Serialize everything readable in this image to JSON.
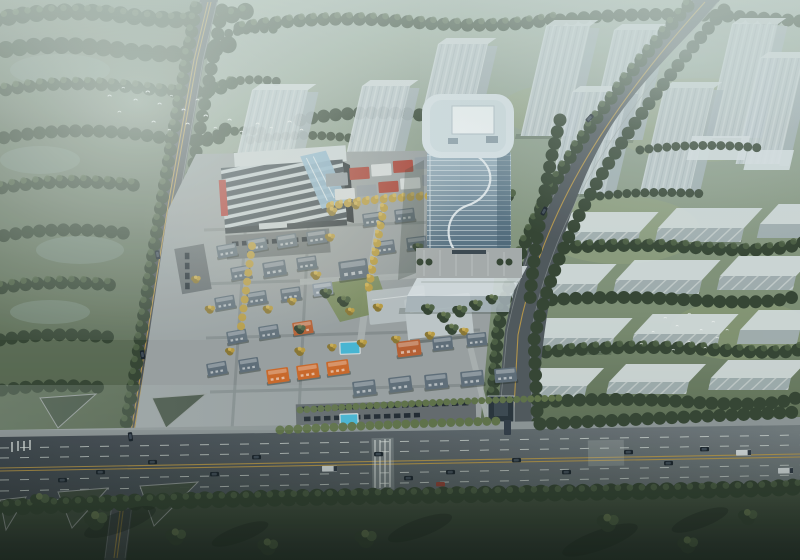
{
  "scene": {
    "description": "Aerial dusk rendering of a mixed-use development: curved glass office tower, striped-roof commercial anchor with red signage, low-rise European-style retail and villa village with slate and terracotta roofs and turquoise pools, translucent context towers and slabs, forest in haze, bird flocks, and a multi-lane boulevard crossed by two side roads."
  },
  "palette": {
    "tree_dark": "#31402f",
    "tree_mid": "#4c5f42",
    "tree_light": "#687950",
    "tree_yellow": "#b99a3f",
    "tree_yellow2": "#d3b254",
    "grass_cool": "#7e9186",
    "ghost_face": "#c5cfd6",
    "ghost_side": "#a7b3ba",
    "ghost_top": "#dde4e8",
    "glass_top": "#a7bcc9",
    "glass_bot": "#50697c",
    "tower_roof": "#d9e3e8",
    "tower_skylight": "#eef3f5",
    "tower_ribbon": "#eaf0f3",
    "roof_grey": "#5d6b77",
    "roof_grey_light": "#8793a0",
    "roof_orange": "#b85c2f",
    "roof_orange_bright": "#cd6526",
    "wall_cream": "#d8d5cb",
    "sign_red": "#b1302a",
    "shop_red": "#a83a2e",
    "shop_white": "#d6dadb",
    "shop_grey": "#8d969e",
    "atrium_blue": "#8fb6d0",
    "pool_cyan": "#45b6d6",
    "site_ground": "#999fa1",
    "plaza": "#a6abac",
    "lawn": "#78885a",
    "street_grey": "#81888b",
    "parking_grey": "#62686c",
    "sidewalk": "#8b9294",
    "road_dark": "#3f454d",
    "road_mid": "#565d63",
    "road_light": "#777e81",
    "lane_white": "#d6dcd8",
    "lane_yellow": "#c09a45",
    "island_green": "#3e4b3d",
    "car_dark": "#161e28",
    "car_glass": "#3c4754",
    "truck_white": "#d9dee1",
    "car_red": "#8e3a30",
    "bird_white": "#f4f7f6",
    "shadow": "#1c2620"
  },
  "elements": {
    "glass_tower": "curved glass office tower with rooftop skylight",
    "commercial_center": "striped-roof retail anchor with red sign band and glass atrium",
    "retail_village": "shop rows with red and white fronts",
    "villa_district": "low-rise blocks with slate and terracotta mansard roofs",
    "pools": "turquoise swimming pools",
    "ghost_towers": "translucent context high-rises",
    "ghost_slabs": "translucent low residential slabs on lawn",
    "forest": "tree canopy in morning haze with clearings",
    "bird_flocks": "white birds over forest and on lawn",
    "main_road": "multi-lane boulevard with cars, trucks and crosswalks",
    "west_road": "tree-lined avenue crossing the boulevard at a channelized intersection",
    "east_road": "curved access road joining the boulevard"
  }
}
